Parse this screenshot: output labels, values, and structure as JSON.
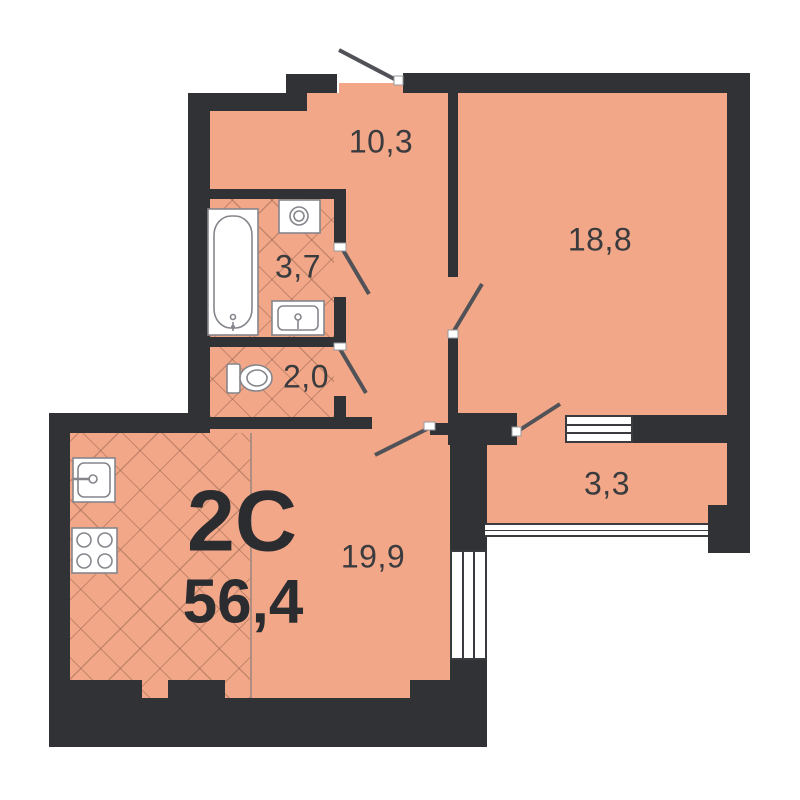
{
  "plan": {
    "apartment_type": "2C",
    "total_area": "56,4",
    "rooms": {
      "hallway": {
        "area": "10,3"
      },
      "living_room": {
        "area": "18,8"
      },
      "bathroom": {
        "area": "3,7"
      },
      "wc": {
        "area": "2,0"
      },
      "kitchen_living": {
        "area": "19,9"
      },
      "balcony": {
        "area": "3,3"
      }
    },
    "fixtures": [
      "bathtub",
      "washing-machine",
      "bathroom-sink",
      "toilet",
      "kitchen-sink",
      "stove",
      "entrance-door",
      "interior-door",
      "balcony-door",
      "balcony-window",
      "room-window",
      "balcony-glazing"
    ],
    "colors": {
      "floor": "#F2A788",
      "wall": "#303236",
      "door_leaf": "#515257",
      "fixture_stroke": "#85868C",
      "label": "#3A3B3E",
      "big_label": "#2B2C30"
    }
  }
}
